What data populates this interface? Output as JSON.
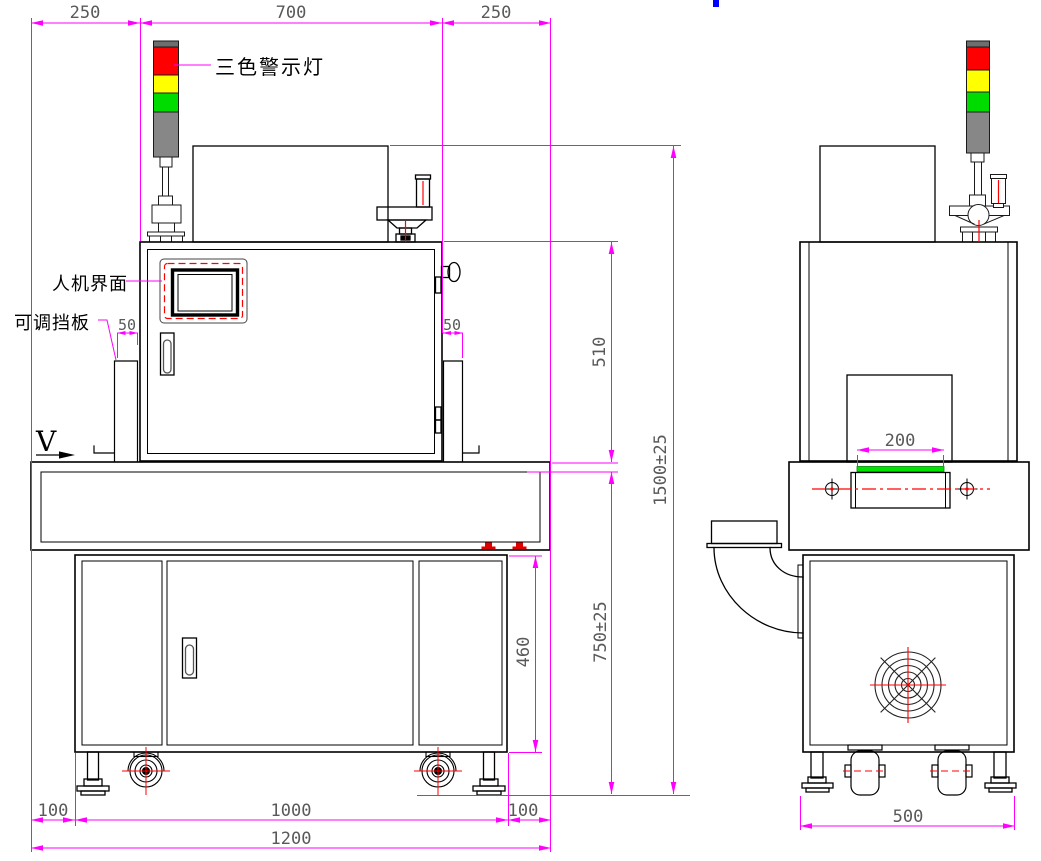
{
  "drawing": {
    "type": "engineering-dimension-drawing",
    "views": [
      "front-view",
      "side-view"
    ],
    "labels": {
      "tower": "三色警示灯",
      "hmi": "人机界面",
      "baffle": "可调挡板",
      "view": "V"
    },
    "dims": {
      "d250l": "250",
      "d700": "700",
      "d250r": "250",
      "d50l": "50",
      "d50r": "50",
      "d510": "510",
      "d1500": "1500±25",
      "d750": "750±25",
      "d460": "460",
      "d100l": "100",
      "d1000": "1000",
      "d100r": "100",
      "d1200": "1200",
      "d200": "200",
      "d500": "500"
    },
    "colors": {
      "dimension": "#FF00FF",
      "outline": "#000000",
      "red": "#FF0000",
      "yellow": "#FFFF00",
      "green": "#00DC00",
      "gray": "#878787",
      "belt_green": "#00E400",
      "blue": "#0000FF",
      "dim_text": "#595959"
    }
  }
}
